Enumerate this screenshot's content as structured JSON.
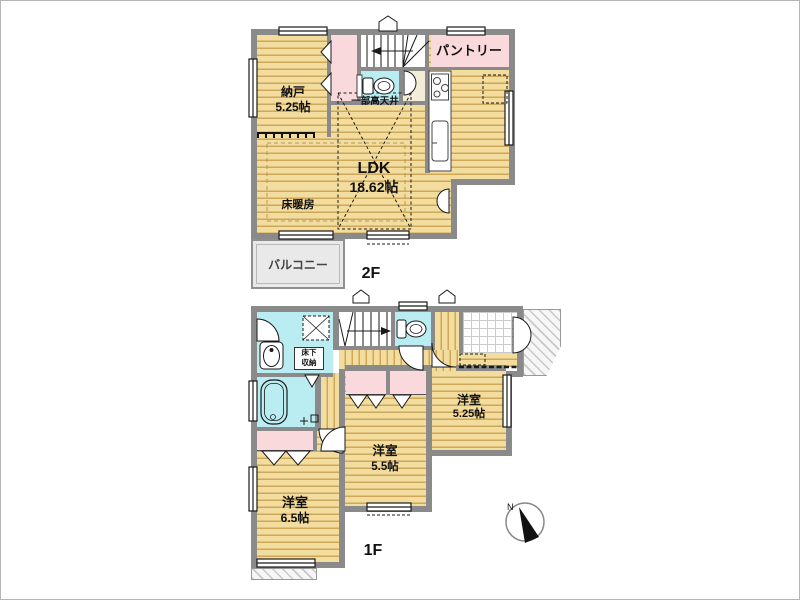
{
  "floor2": {
    "label": "2F",
    "nando_name": "納戸",
    "nando_size": "5.25帖",
    "pantry": "パントリー",
    "high_ceiling_note": "一部高天井",
    "ldk_name": "LDK",
    "ldk_size": "18.62帖",
    "floor_heating": "床暖房",
    "balcony": "バルコニー"
  },
  "floor1": {
    "label": "1F",
    "underfloor_line1": "床下",
    "underfloor_line2": "収納",
    "room_a_name": "洋室",
    "room_a_size": "5.25帖",
    "room_b_name": "洋室",
    "room_b_size": "5.5帖",
    "room_c_name": "洋室",
    "room_c_size": "6.5帖",
    "compass_north": "N"
  },
  "colors": {
    "wood_floor": "#f3dd9e",
    "wood_stripe": "#cda85a",
    "wet_area_cyan": "#b9edf2",
    "closet_pink": "#f9d9dc",
    "wall_gray": "#8a8a8a",
    "hall_beige": "#f3ecd7",
    "balcony_gray": "#e9e9e9"
  }
}
